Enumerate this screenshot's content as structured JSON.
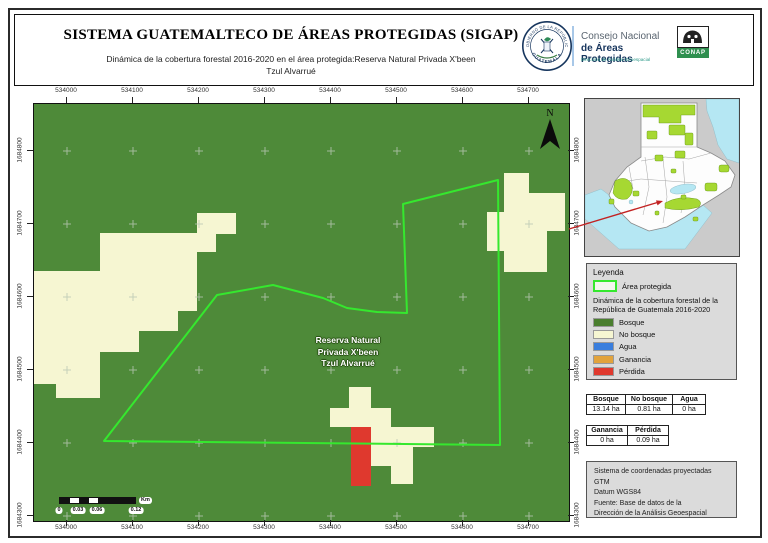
{
  "header": {
    "title": "SISTEMA GUATEMALTECO DE ÁREAS PROTEGIDAS (SIGAP)",
    "subtitle_line1": "Dinámica de la cobertura forestal 2016-2020 en el área protegida:Reserva Natural Privada X'been",
    "subtitle_line2": "Tzul Alvarrué",
    "seal": {
      "top_text": "GOBIERNO DE LA REPÚBLICA",
      "bottom_text": "GUATEMALA"
    },
    "conap": {
      "line1": "Consejo Nacional",
      "line2": "de Áreas Protegidas",
      "line3": "Dirección de Análisis Geoespacial",
      "badge": "CONAP"
    }
  },
  "map": {
    "x_ticks": [
      "534000",
      "534100",
      "534200",
      "534300",
      "534400",
      "534500",
      "534600",
      "534700"
    ],
    "y_ticks": [
      "1684800",
      "1684700",
      "1684600",
      "1684500",
      "1684400",
      "1684300"
    ],
    "north_label": "N",
    "area_label": [
      "Reserva Natural",
      "Privada X'been",
      "Tzul Alvarrué"
    ],
    "scalebar": {
      "labels": [
        "0",
        "0.03",
        "0.06",
        "0.12"
      ],
      "unit": "Km"
    }
  },
  "legend": {
    "title": "Leyenda",
    "area_item": "Área protegida",
    "caption": "Dinámica de la cobertura forestal de la República de Guatemala 2016-2020",
    "items": [
      {
        "label": "Bosque",
        "color": "#4a7e2e"
      },
      {
        "label": "No bosque",
        "color": "#f6f6d2"
      },
      {
        "label": "Agua",
        "color": "#3a7edd"
      },
      {
        "label": "Ganancia",
        "color": "#e2a33c"
      },
      {
        "label": "Pérdida",
        "color": "#df392e"
      }
    ]
  },
  "stats": {
    "table1": {
      "headers": [
        "Bosque",
        "No bosque",
        "Agua"
      ],
      "values": [
        "13.14 ha",
        "0.81 ha",
        "0 ha"
      ]
    },
    "table2": {
      "headers": [
        "Ganancia",
        "Pérdida"
      ],
      "values": [
        "0 ha",
        "0.09 ha"
      ]
    }
  },
  "info_box": {
    "lines": [
      "Sistema de coordenadas proyectadas",
      "GTM",
      "Datum WGS84",
      "Fuente: Base de datos de la",
      "Dirección de la Análisis Geoespacial"
    ]
  },
  "colors": {
    "bosque_green": "#4e8a39",
    "no_bosque_cream": "#f6f6d2",
    "perdida_red": "#df392e",
    "boundary_green": "#35e82e",
    "inset_protected_green": "#a6d832",
    "inset_water": "#b5e7f3",
    "inset_land_gray": "#cbcbcb",
    "panel_gray": "#dbdbdb",
    "conap_navy": "#17365e",
    "conap_green": "#2f8f4f",
    "arrow_red": "#c22222"
  }
}
